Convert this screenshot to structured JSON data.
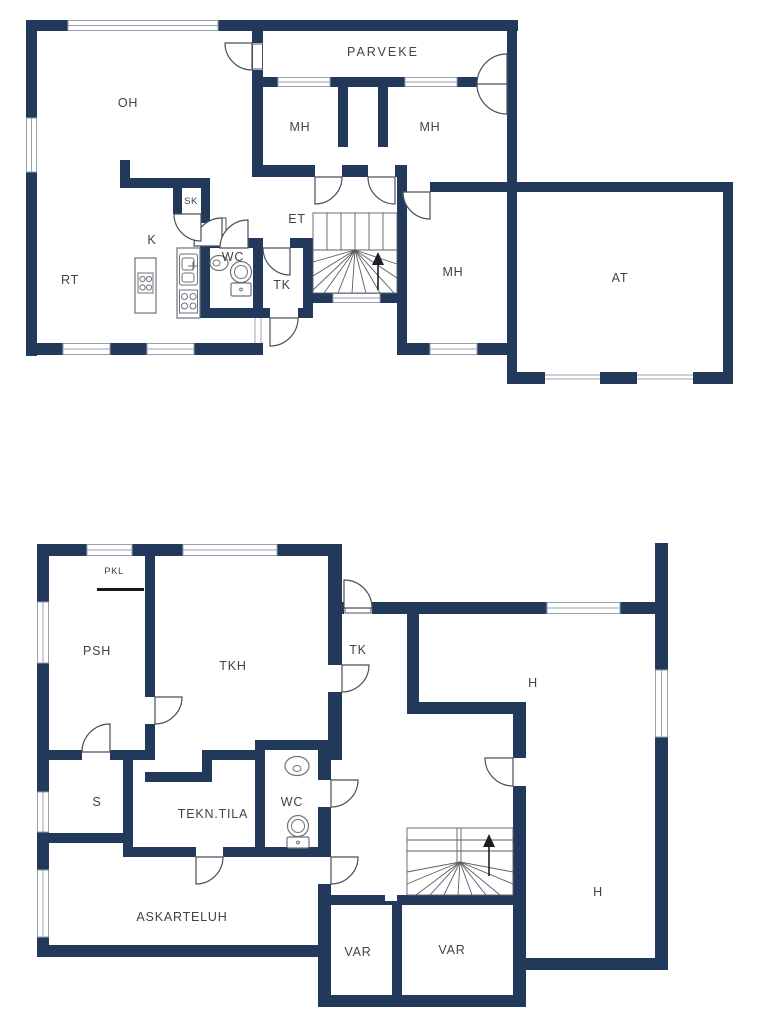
{
  "figure_type": "floor-plan",
  "palette": {
    "wall": "#23395b",
    "window_line": "#98a0ab",
    "door_line": "#4b5058",
    "fixture_line": "#6e737a",
    "stair_line": "#5a5e64",
    "text": "#3f434a",
    "background": "#ffffff"
  },
  "floor_upper": {
    "labels": [
      {
        "id": "oh",
        "label": "OH"
      },
      {
        "id": "parveke",
        "label": "PARVEKE"
      },
      {
        "id": "mh-left",
        "label": "MH"
      },
      {
        "id": "mh-right",
        "label": "MH"
      },
      {
        "id": "mh-lower",
        "label": "MH"
      },
      {
        "id": "et",
        "label": "ET"
      },
      {
        "id": "sk",
        "label": "SK"
      },
      {
        "id": "k",
        "label": "K"
      },
      {
        "id": "rt",
        "label": "RT"
      },
      {
        "id": "wc",
        "label": "WC"
      },
      {
        "id": "tk",
        "label": "TK"
      },
      {
        "id": "at",
        "label": "AT"
      }
    ]
  },
  "floor_lower": {
    "labels": [
      {
        "id": "pkl",
        "label": "PKL"
      },
      {
        "id": "psh",
        "label": "PSH"
      },
      {
        "id": "tkh",
        "label": "TKH"
      },
      {
        "id": "tk",
        "label": "TK"
      },
      {
        "id": "h-upper",
        "label": "H"
      },
      {
        "id": "h-lower",
        "label": "H"
      },
      {
        "id": "s",
        "label": "S"
      },
      {
        "id": "tekn-tila",
        "label": "TEKN.TILA"
      },
      {
        "id": "wc",
        "label": "WC"
      },
      {
        "id": "askarteluh",
        "label": "ASKARTELUH"
      },
      {
        "id": "var-left",
        "label": "VAR"
      },
      {
        "id": "var-right",
        "label": "VAR"
      }
    ]
  }
}
